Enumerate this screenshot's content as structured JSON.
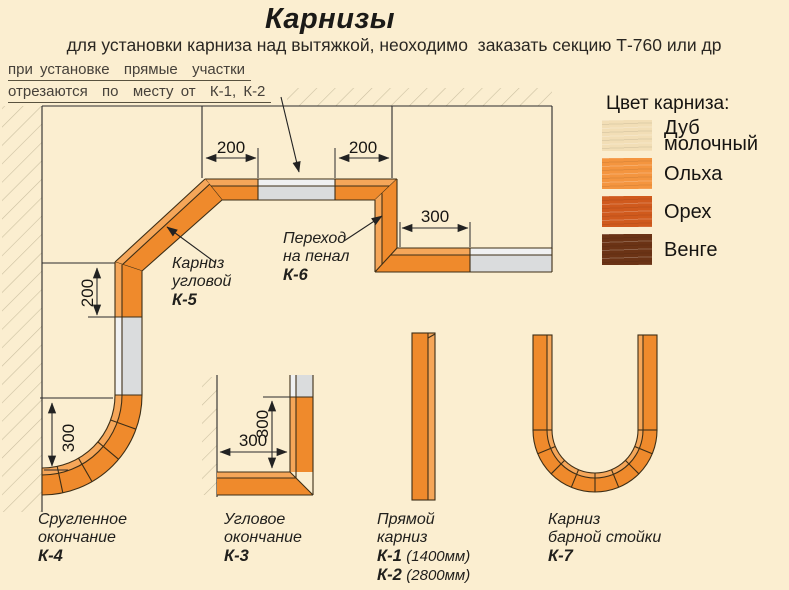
{
  "title": "Карнизы",
  "subtitle": "для установки карниза над вытяжкой, неоходимо  заказать секцию Т-760 или др",
  "note": {
    "line1": "при установке  прямые  участки",
    "line2": "отрезаются  по  месту от  К-1, К-2"
  },
  "legend": {
    "title": "Цвет карниза:",
    "items": [
      {
        "name": "Дуб молочный",
        "lines": [
          "Дуб",
          "молочный"
        ],
        "color": "#F2DEB6"
      },
      {
        "name": "Ольха",
        "lines": [
          "Ольха"
        ],
        "color": "#F4953F"
      },
      {
        "name": "Орех",
        "lines": [
          "Орех"
        ],
        "color": "#D05A1D"
      },
      {
        "name": "Венге",
        "lines": [
          "Венге"
        ],
        "color": "#6B3315"
      }
    ]
  },
  "dims": {
    "d200": "200",
    "d300": "300"
  },
  "callouts": {
    "k5": {
      "line1": "Карниз",
      "line2": "угловой",
      "code": "К-5"
    },
    "k6": {
      "line1": "Переход",
      "line2": "на пенал",
      "code": "К-6"
    }
  },
  "captions": {
    "k4": {
      "line1": "Сругленное",
      "line2": "окончание",
      "code": "К-4"
    },
    "k3": {
      "line1": "Угловое",
      "line2": "окончание",
      "code": "К-3"
    },
    "k12": {
      "line1": "Прямой",
      "line2": "карниз",
      "code1": "К-1",
      "size1": "(1400мм)",
      "code2": "К-2",
      "size2": "(2800мм)"
    },
    "k7": {
      "line1": "Карниз",
      "line2": "барной стойки",
      "code": "К-7"
    }
  },
  "colors": {
    "bg": "#FBEED0",
    "orange-main": "#EF8A2C",
    "orange-light": "#F5A659",
    "gray-main": "#DADCDD",
    "gray-light": "#F0F1F2",
    "line": "#2B2B2B",
    "outline": "#3D2E16",
    "hatch": "#CBBFA0",
    "text": "#1E1C18"
  }
}
